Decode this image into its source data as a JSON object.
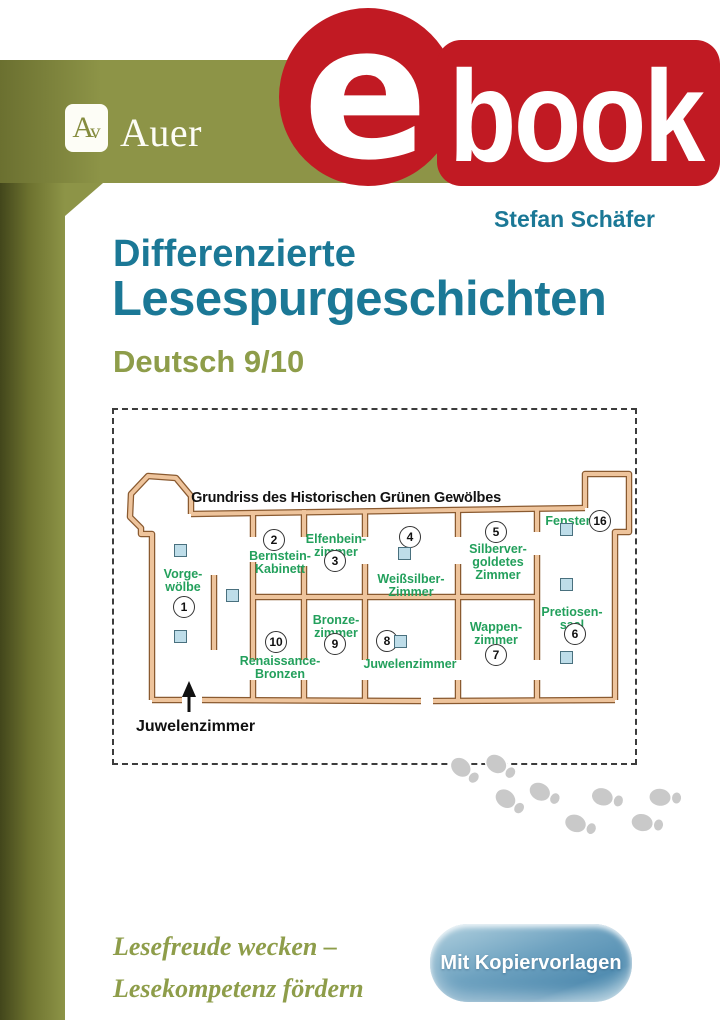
{
  "publisher": {
    "monogram_a": "A",
    "monogram_v": "v",
    "name": "Auer"
  },
  "ebook_badge": {
    "e": "e",
    "book": "book"
  },
  "author": "Stefan Schäfer",
  "title_line1": "Differenzierte",
  "title_line2": "Lesespurgeschichten",
  "subtitle": "Deutsch 9/10",
  "floorplan": {
    "title": "Grundriss des Historischen Grünen Gewölbes",
    "entrance_label": "Juwelenzimmer",
    "rooms": [
      {
        "n": "1",
        "label": "Vorge-\nwölbe",
        "lx": 69,
        "ly": 158,
        "cx": 70,
        "cy": 197
      },
      {
        "n": "2",
        "label": "Bernstein-\nKabinett",
        "lx": 166,
        "ly": 140,
        "cx": 160,
        "cy": 130
      },
      {
        "n": "3",
        "label": "Elfenbein-\nzimmer",
        "lx": 222,
        "ly": 123,
        "cx": 221,
        "cy": 151
      },
      {
        "n": "4",
        "label": "Weißsilber-\nZimmer",
        "lx": 297,
        "ly": 163,
        "cx": 296,
        "cy": 127
      },
      {
        "n": "5",
        "label": "Silberver-\ngoldetes\nZimmer",
        "lx": 384,
        "ly": 133,
        "cx": 382,
        "cy": 122
      },
      {
        "n": "6",
        "label": "Pretiosen-\nsaal",
        "lx": 458,
        "ly": 196,
        "cx": 461,
        "cy": 224
      },
      {
        "n": "7",
        "label": "Wappen-\nzimmer",
        "lx": 382,
        "ly": 211,
        "cx": 382,
        "cy": 245
      },
      {
        "n": "8",
        "label": "Juwelenzimmer",
        "lx": 296,
        "ly": 248,
        "cx": 273,
        "cy": 231
      },
      {
        "n": "9",
        "label": "Bronze-\nzimmer",
        "lx": 222,
        "ly": 204,
        "cx": 221,
        "cy": 234
      },
      {
        "n": "10",
        "label": "Renaissance-\nBronzen",
        "lx": 166,
        "ly": 245,
        "cx": 162,
        "cy": 232
      },
      {
        "n": "16",
        "label": "Fenster",
        "lx": 454,
        "ly": 105,
        "cx": 486,
        "cy": 111
      }
    ],
    "windows": [
      [
        60,
        134
      ],
      [
        60,
        220
      ],
      [
        112,
        179
      ],
      [
        284,
        137
      ],
      [
        280,
        225
      ],
      [
        446,
        113
      ],
      [
        446,
        168
      ],
      [
        446,
        241
      ]
    ]
  },
  "decor": {
    "footprints_icon": "shoe-print-trail",
    "footprint_count": 8
  },
  "tagline_line1": "Lesefreude wecken –",
  "tagline_line2": "Lesekompetenz fördern",
  "cta_button": "Mit Kopiervorlagen",
  "colors": {
    "accent_red": "#c11a23",
    "olive": "#8d9447",
    "teal_title": "#1b7896",
    "room_label_green": "#23a05c",
    "wall_fill": "#eec49c",
    "wall_outline": "#8a5a30",
    "window_blue": "#bedde9",
    "button_blue": "#6ea2c0",
    "footprint_gray": "#c9c9c9"
  }
}
